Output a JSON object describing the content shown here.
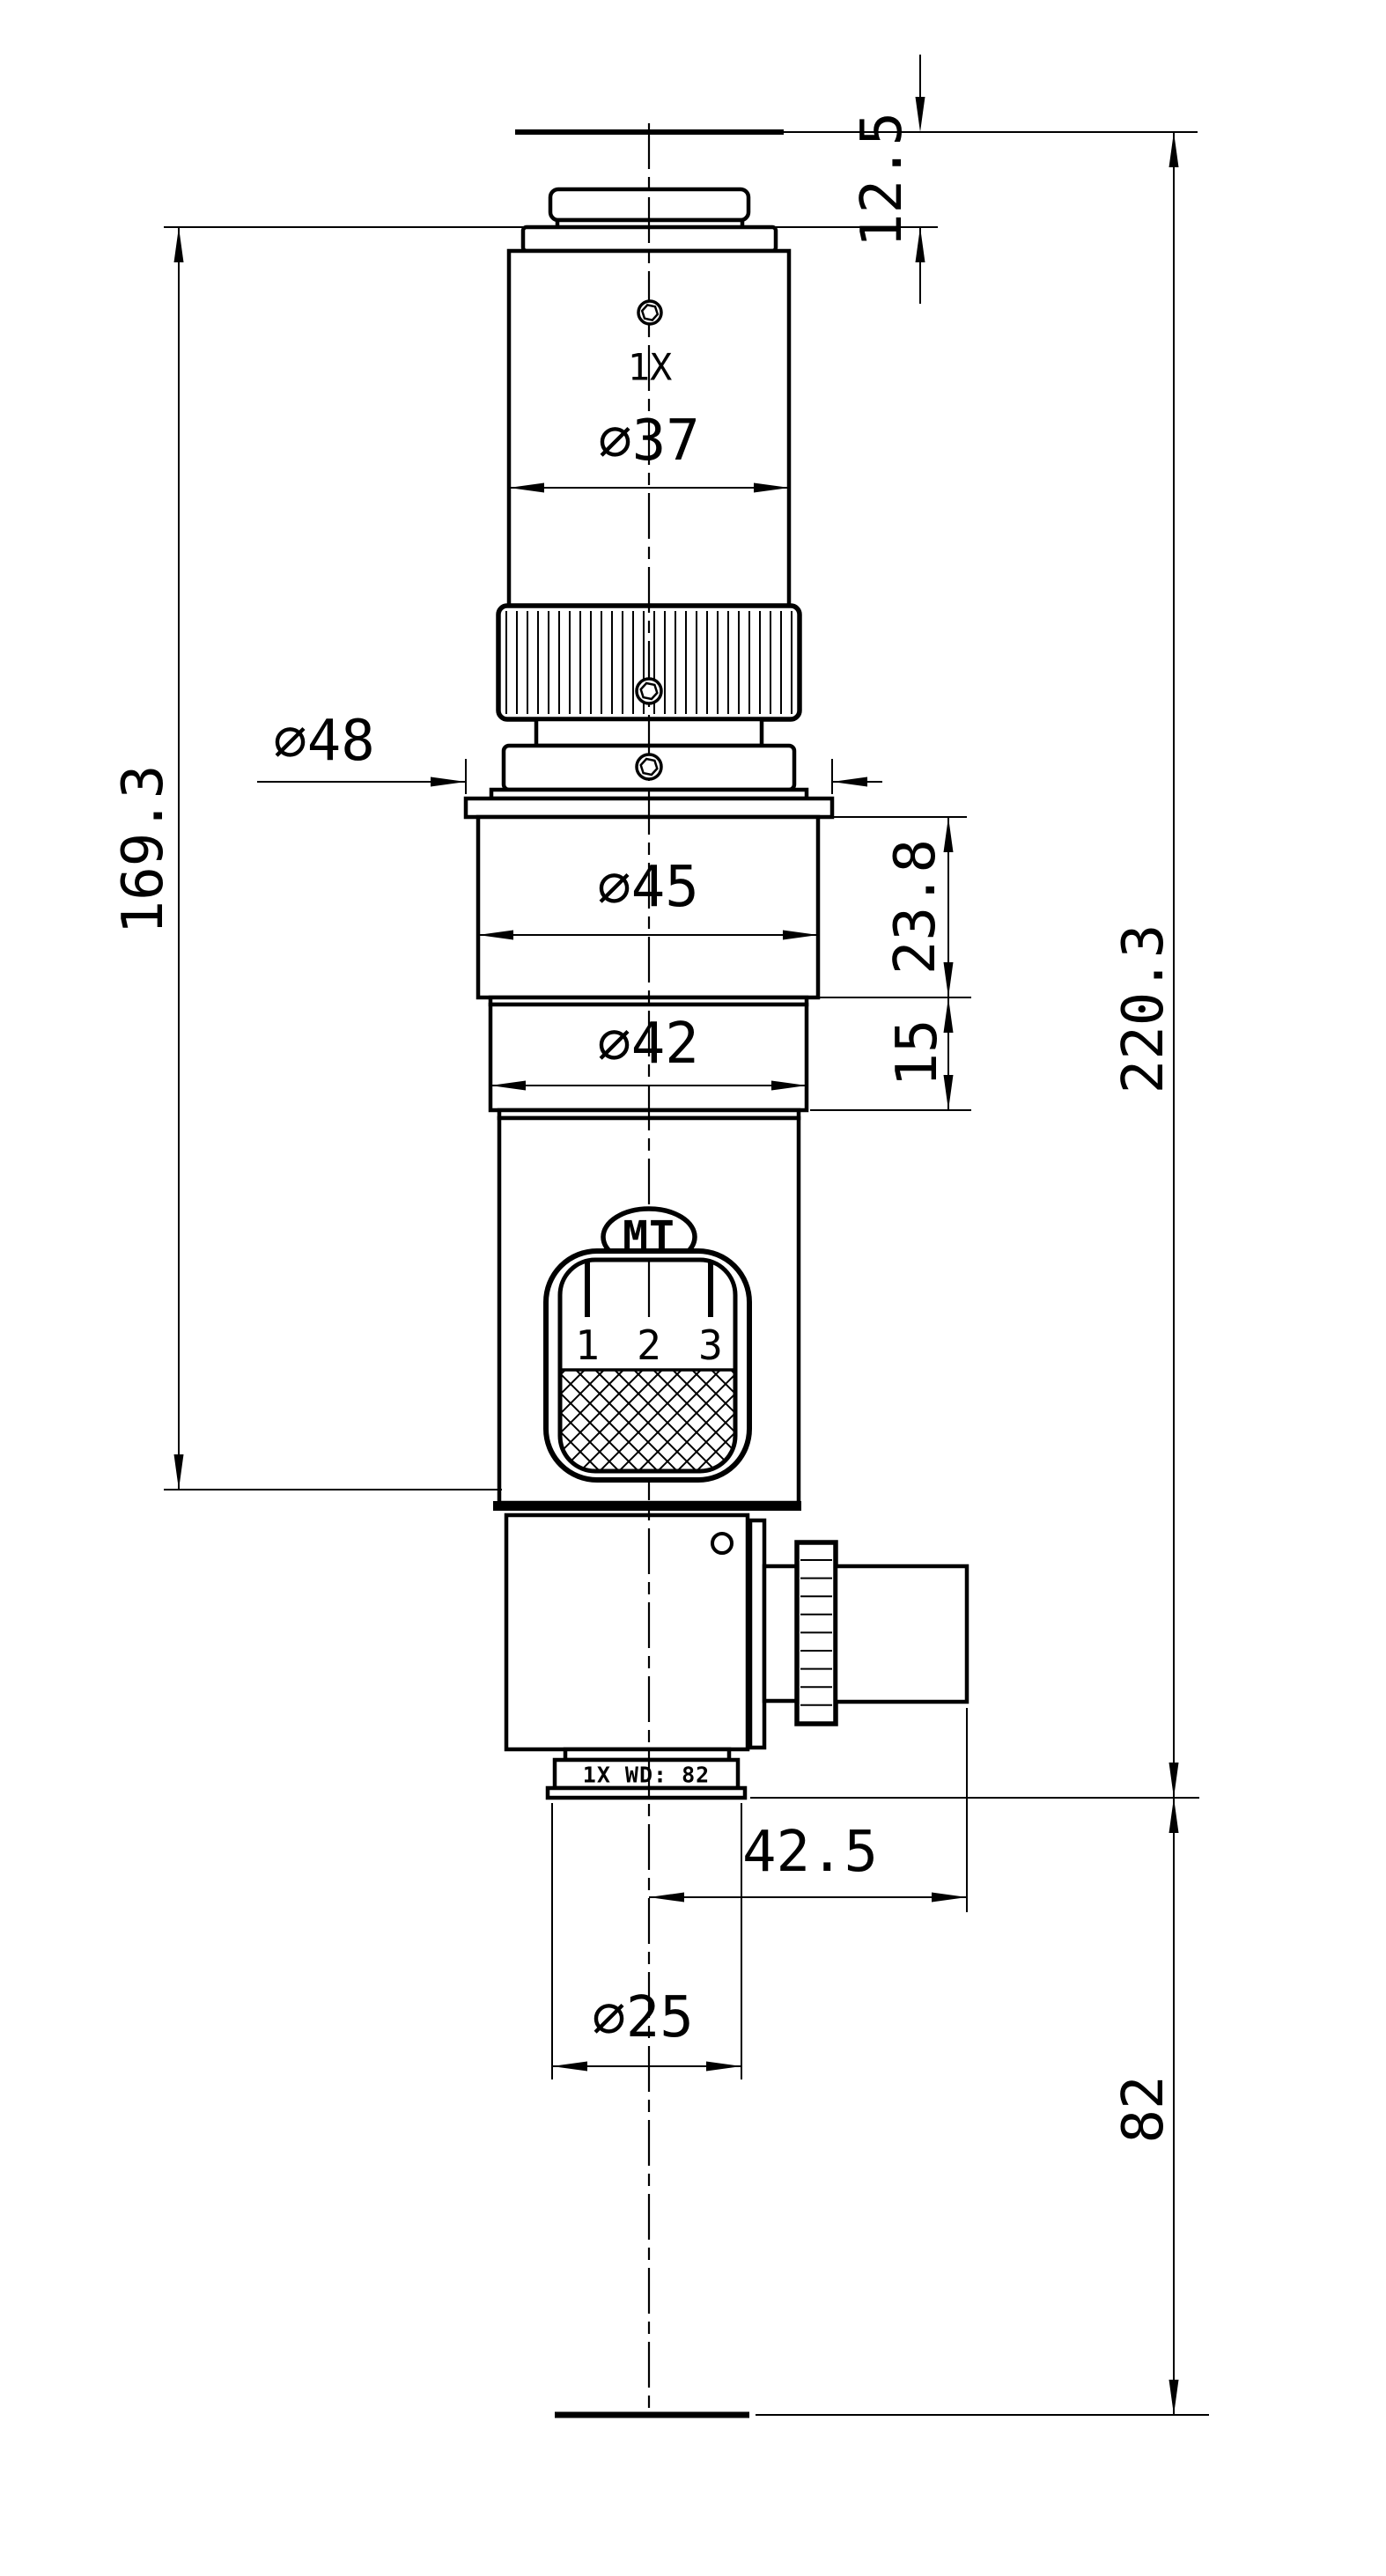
{
  "drawing": {
    "dimensions": {
      "top_offset": "12.5",
      "dia_upper_barrel": "∅37",
      "dia_flange": "∅48",
      "dia_body45": "∅45",
      "h_body45": "23.8",
      "dia_body42": "∅42",
      "h_body42": "15",
      "h_upper_assembly": "169.3",
      "h_overall": "220.3",
      "side_port_offset": "42.5",
      "dia_objective": "∅25",
      "working_distance": "82"
    },
    "labels": {
      "top_magnification": "1X",
      "brand": "MT",
      "zoom_scale_1": "1",
      "zoom_scale_2": "2",
      "zoom_scale_3": "3",
      "objective_marking": "1X  WD: 82"
    },
    "colors": {
      "ink": "#000000",
      "paper": "#ffffff"
    }
  }
}
